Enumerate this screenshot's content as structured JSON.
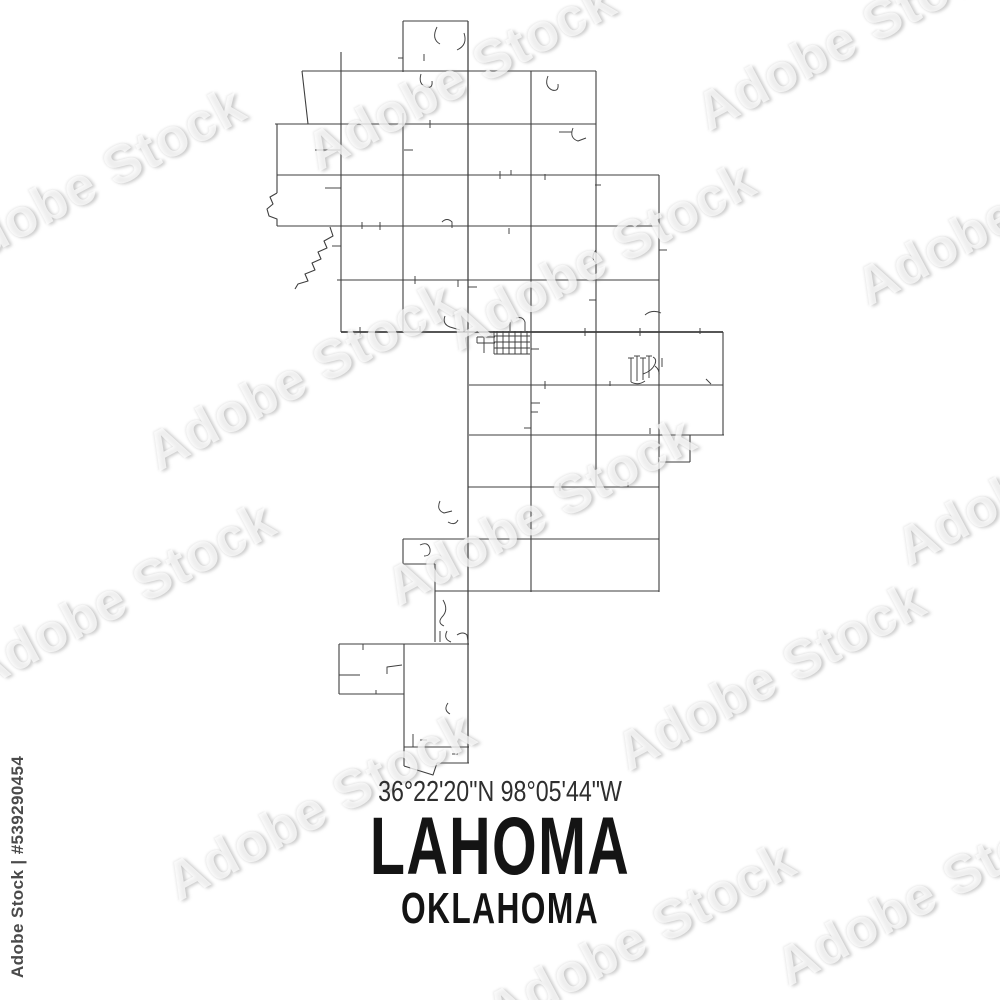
{
  "image": {
    "kind": "stock map print",
    "background_color": "#ffffff"
  },
  "label_block": {
    "coordinates": "36°22'20\"N 98°05'44\"W",
    "city": "LAHOMA",
    "state": "OKLAHOMA",
    "coordinates_color": "#2e2e2e",
    "title_color": "#141414"
  },
  "watermark": {
    "text": "Adobe Stock",
    "stock_id_label": "Adobe Stock | #539290454",
    "rotation_deg": -28,
    "instances": [
      {
        "x": -80,
        "y": 150
      },
      {
        "x": 130,
        "y": 345
      },
      {
        "x": -50,
        "y": 565
      },
      {
        "x": 150,
        "y": 775
      },
      {
        "x": 290,
        "y": 45
      },
      {
        "x": 430,
        "y": 225
      },
      {
        "x": 370,
        "y": 480
      },
      {
        "x": 600,
        "y": 645
      },
      {
        "x": 680,
        "y": 5
      },
      {
        "x": 840,
        "y": 180
      },
      {
        "x": 880,
        "y": 440
      },
      {
        "x": 760,
        "y": 860
      },
      {
        "x": 470,
        "y": 905
      }
    ]
  },
  "map": {
    "stroke_color": "#3e3e3e",
    "layers": [
      {
        "name": "highway-road",
        "stroke_width": 1.8,
        "paths": [
          "M341,332 L723,332"
        ]
      },
      {
        "name": "main-road",
        "stroke_width": 1.25,
        "paths": [
          "M468,21 L468,763"
        ]
      },
      {
        "name": "section-road",
        "stroke_width": 1.1,
        "paths": [
          "M403,21 L468,21",
          "M403,21 L403,72",
          "M302,71 L596,71",
          "M302,71 L308,124",
          "M275,124 L596,124",
          "M277,175 L659,175",
          "M277,226 L659,226",
          "M337,280 L659,280",
          "M469,385 L723,385",
          "M469,435 L724,435",
          "M690,435 L690,462",
          "M660,462 L690,462",
          "M468,487 L659,487",
          "M403,539 L659,539",
          "M403,539 L403,564",
          "M403,564 L435,564",
          "M435,591 L659,591",
          "M339,644 L469,644",
          "M339,644 L339,694",
          "M339,694 L404,694",
          "M404,747 L469,747",
          "M437,763 L469,763",
          "M404,766 L433,775 L437,763",
          "M341,52 L341,332",
          "M403,113 L403,332",
          "M531,71 L531,592",
          "M596,71 L596,487",
          "M659,175 L659,592",
          "M723,332 L723,435",
          "M277,124 L277,193",
          "M435,564 L435,642",
          "M404,644 L404,766",
          "M277,193 L270,197 L273,204 L267,209 L269,216 L277,219 L277,226",
          "M330,227 L333,236 L324,241 L327,248 L318,252 L321,259 L312,263 L315,270 L305,274 L308,281 L298,284 L295,289"
        ]
      },
      {
        "name": "minor-road",
        "stroke_width": 0.95,
        "paths": [
          "M437,27 Q431,39 440,44",
          "M464,33 Q468,45 457,50",
          "M424,54 L424,61",
          "M398,58 L403,58",
          "M421,74 Q418,84 426,87 Q433,89 432,81",
          "M548,76 Q544,86 552,90 Q559,92 558,84",
          "M559,132 L572,132",
          "M573,128 Q569,138 578,141 L586,138",
          "M315,150 L341,150",
          "M404,150 L413,150",
          "M325,188 L341,188",
          "M430,120 L430,128",
          "M511,170 L511,175",
          "M545,174 L545,180",
          "M500,171 L500,179",
          "M362,222 L362,229",
          "M380,222 L380,230",
          "M442,222 Q447,217 452,222 L452,228",
          "M509,228 L509,234",
          "M332,246 L341,246",
          "M596,250 Q590,257 596,263",
          "M595,185 L601,185",
          "M468,287 L477,287",
          "M415,276 L415,284",
          "M458,280 L458,287",
          "M589,300 L596,300",
          "M659,250 L667,250",
          "M645,315 Q652,309 661,313",
          "M445,316 Q442,324 450,327 L460,330",
          "M360,327 L360,337",
          "M420,326 L420,332",
          "M585,328 L585,336",
          "M640,328 L640,336",
          "M700,328 L700,334",
          "M545,381 L545,389",
          "M610,381 L610,386",
          "M706,379 L711,384",
          "M531,403 L540,403",
          "M531,412 L538,412",
          "M524,428 L531,428",
          "M650,428 L650,434",
          "M560,483 L560,491",
          "M628,482 L628,487",
          "M420,545 Q428,541 430,549 Q431,556 424,556",
          "M440,501 Q436,510 444,513 L452,511",
          "M448,522 Q455,526 458,520",
          "M443,600 Q449,610 442,617 Q437,623 444,626",
          "M440,631 L440,642",
          "M363,644 L363,650",
          "M339,675 L360,675",
          "M387,674 L387,667 L402,665",
          "M376,690 L376,694",
          "M447,631 Q443,639 451,642",
          "M457,635 Q463,631 467,635 L468,641",
          "M448,703 Q443,710 450,714",
          "M413,734 L413,747",
          "M420,740 L427,740",
          "M452,754 L458,754"
        ]
      },
      {
        "name": "town-street",
        "stroke_width": 0.95,
        "paths": [
          "M494,331 L494,354",
          "M497,331 L497,354",
          "M503,331 L503,354",
          "M509,331 L509,354",
          "M515,331 L515,354",
          "M521,331 L521,354",
          "M527,331 L527,354",
          "M494,336 L530,336",
          "M494,342 L530,342",
          "M494,348 L530,348",
          "M494,354 L530,354",
          "M516,318 Q523,316 525,322 L525,331",
          "M510,322 L510,331",
          "M484,337 L484,353",
          "M477,337 L495,337",
          "M477,343 L495,343",
          "M477,337 L477,343",
          "M531,349 L539,349"
        ]
      },
      {
        "name": "subdivision-street",
        "stroke_width": 0.95,
        "paths": [
          "M628,358 L634,358",
          "M631,358 L631,382",
          "M634,356 L640,356",
          "M637,356 L637,381",
          "M640,358 L646,358",
          "M643,358 L643,380",
          "M646,356 L652,356",
          "M649,356 L649,378",
          "M643,374 Q652,371 655,364 Q657,359 653,357",
          "M655,366 Q660,370 659,376",
          "M662,358 L662,367",
          "M631,382 Q638,386 645,381"
        ]
      }
    ]
  }
}
